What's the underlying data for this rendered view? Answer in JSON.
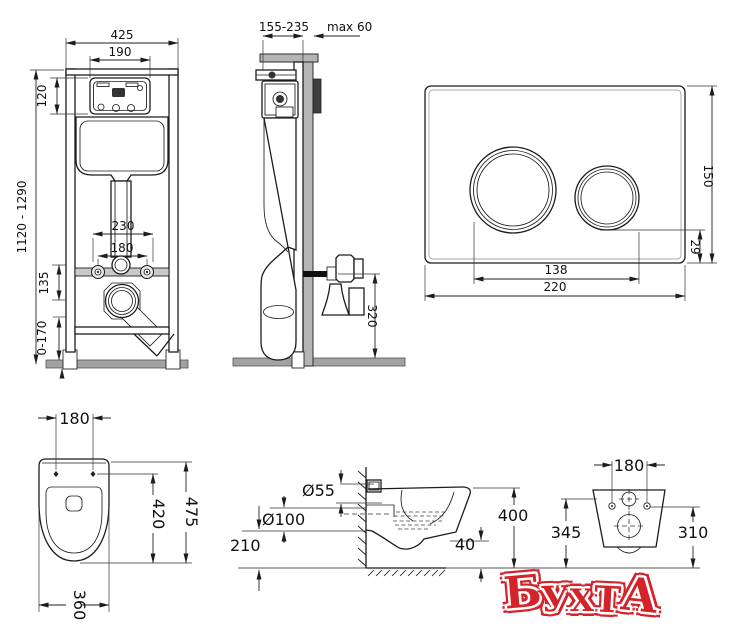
{
  "frame_front": {
    "dim_total_width": "425",
    "dim_window_width": "190",
    "dim_window_height": "120",
    "dim_height_range": "1120 - 1290",
    "dim_fixing_wide": "230",
    "dim_fixing_narrow": "180",
    "dim_drain_offset": "135",
    "dim_foot_range": "0-170"
  },
  "frame_side": {
    "dim_depth_range": "155-235",
    "dim_plate_depth": "max 60",
    "dim_outlet_height": "320"
  },
  "flush_plate": {
    "dim_width": "220",
    "dim_height": "150",
    "dim_buttons_span": "138",
    "dim_bottom_offset": "29"
  },
  "bowl_top": {
    "dim_bolt_spacing": "180",
    "dim_length": "475",
    "dim_inner_length": "420",
    "dim_width": "360"
  },
  "bowl_side": {
    "dim_inlet": "Ø55",
    "dim_outlet": "Ø100",
    "dim_outlet_height": "210",
    "dim_height": "400",
    "dim_rim_gap": "40"
  },
  "bowl_rear": {
    "dim_bolt_spacing": "180",
    "dim_inlet_height": "345",
    "dim_bolt_height": "310"
  },
  "watermark": {
    "letters": [
      "Б",
      "У",
      "Х",
      "Т",
      "А"
    ],
    "color": "#d4232a"
  }
}
